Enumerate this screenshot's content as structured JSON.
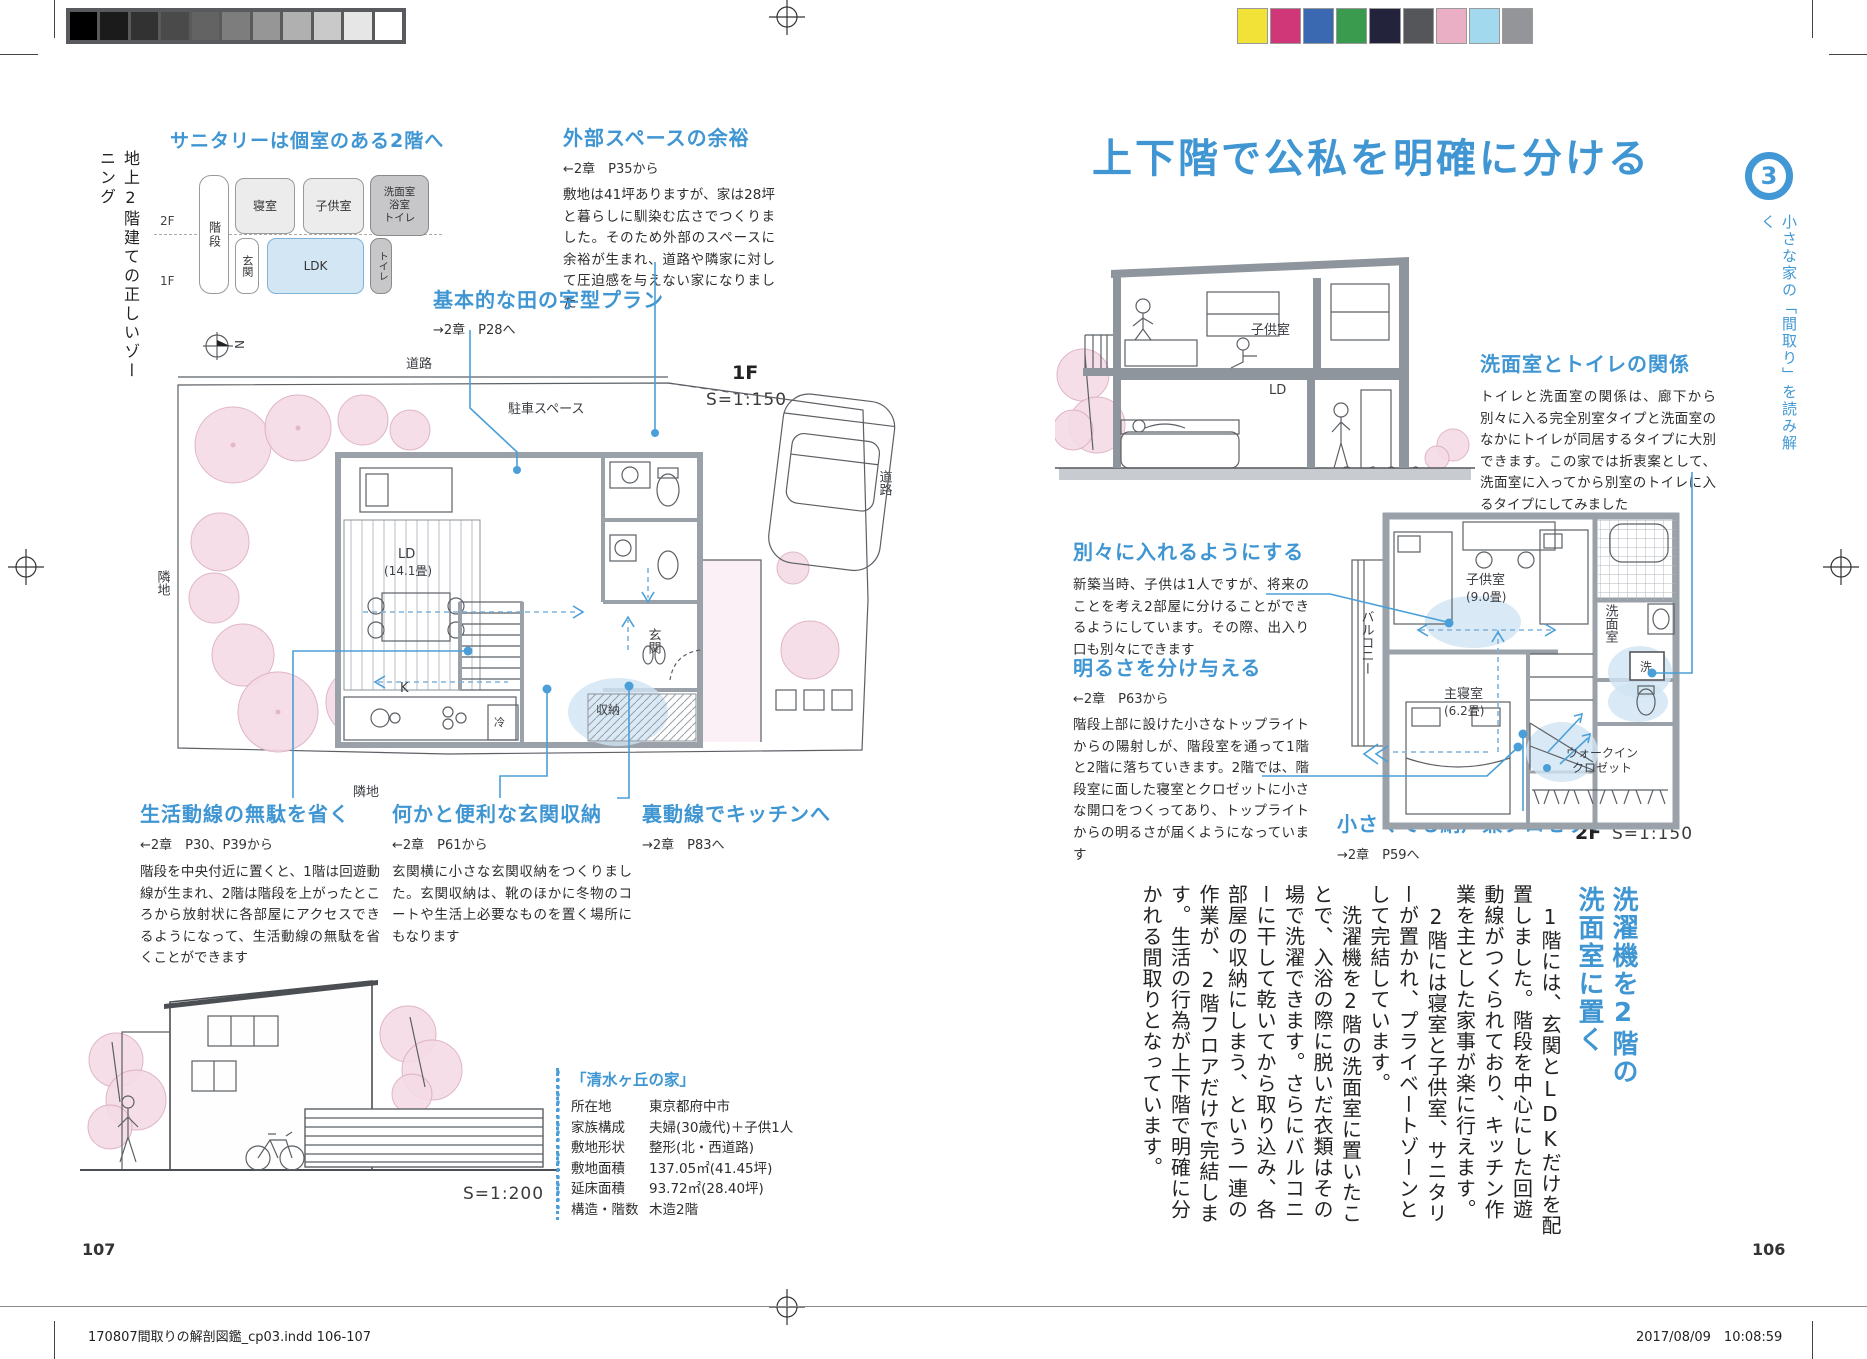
{
  "print": {
    "footer_left": "170807間取りの解剖図鑑_cp03.indd   106-107",
    "footer_right": "2017/08/09　10:08:59",
    "grayscale_swatches": [
      "#000000",
      "#1b1b1b",
      "#323232",
      "#4a4a4a",
      "#636363",
      "#7d7d7d",
      "#969696",
      "#b0b0b0",
      "#c9c9c9",
      "#e6e6e6",
      "#ffffff"
    ],
    "color_swatches": [
      "#f2e136",
      "#cf3779",
      "#3b69b1",
      "#3a9a4e",
      "#23233b",
      "#55565a",
      "#eaaec5",
      "#a2d9ee",
      "#939598"
    ]
  },
  "colors": {
    "accent_blue": "#3f96d2",
    "callout_blue": "#4a9fd8",
    "room_blue": "#d3e6f4",
    "room_gray": "#ececec",
    "room_dark": "#c7c7c9",
    "tree_pink": "#f5dbe6"
  },
  "left_page": {
    "page_number": "107",
    "sidebar_label": "地上2階建ての正しいゾーニング",
    "zoning": {
      "heading": "サニタリーは個室のある2階へ",
      "floor_2f": "2F",
      "floor_1f": "1F",
      "rooms": {
        "stairs": "階段",
        "bedroom": "寝室",
        "kids": "子供室",
        "sanitary": "洗面室\n浴室\nトイレ",
        "entrance": "玄関",
        "ldk": "LDK",
        "toilet": "トイレ"
      }
    },
    "annotations": {
      "outdoor": {
        "title": "外部スペースの余裕",
        "ref": "←2章　P35から",
        "body": "敷地は41坪ありますが、家は28坪と暮らしに馴染む広さでつくりました。そのため外部のスペースに余裕が生まれ、道路や隣家に対して圧迫感を与えない家になりました"
      },
      "grid_plan": {
        "title": "基本的な田の字型プラン",
        "ref": "→2章　P28へ"
      },
      "flow": {
        "title": "生活動線の無駄を省く",
        "ref": "←2章　P30、P39から",
        "body": "階段を中央付近に置くと、1階は回遊動線が生まれ、2階は階段を上がったところから放射状に各部屋にアクセスできるようになって、生活動線の無駄を省くことができます"
      },
      "storage": {
        "title": "何かと便利な玄関収納",
        "ref": "←2章　P61から",
        "body": "玄関横に小さな玄関収納をつくりました。玄関収納は、靴のほかに冬物のコートや生活上必要なものを置く場所にもなります"
      },
      "back_line": {
        "title": "裏動線でキッチンへ",
        "ref": "→2章　P83へ"
      }
    },
    "plan_1f": {
      "floor_label": "1F",
      "scale": "S=1:150",
      "labels": {
        "road_top": "道路",
        "parking": "駐車スペース",
        "ld": "LD",
        "ld_size": "(14.1畳)",
        "entrance": "玄関",
        "kitchen": "K",
        "fridge": "冷",
        "storage": "収納",
        "neighbor_left": "隣地",
        "neighbor_bottom": "隣地",
        "road_right": "道路",
        "north": "N"
      }
    },
    "elevation": {
      "scale": "S=1:200"
    },
    "house_info": {
      "title": "「清水ヶ丘の家」",
      "rows": [
        {
          "label": "所在地",
          "value": "東京都府中市"
        },
        {
          "label": "家族構成",
          "value": "夫婦(30歳代)＋子供1人"
        },
        {
          "label": "敷地形状",
          "value": "整形(北・西道路)"
        },
        {
          "label": "敷地面積",
          "value": "137.05㎡(41.45坪)"
        },
        {
          "label": "延床面積",
          "value": "93.72㎡(28.40坪)"
        },
        {
          "label": "構造・階数",
          "value": "木造2階"
        }
      ]
    }
  },
  "right_page": {
    "page_number": "106",
    "title": "上下階で公私を明確に分ける",
    "chapter_tab": {
      "number": "3",
      "label": "小さな家の「間取り」を読み解く"
    },
    "section": {
      "scale": "S=1:200",
      "labels": {
        "kids": "子供室",
        "ld": "LD"
      }
    },
    "annotations": {
      "wash_toilet": {
        "title": "洗面室とトイレの関係",
        "body": "トイレと洗面室の関係は、廊下から別々に入る完全別室タイプと洗面室のなかにトイレが同居するタイプに大別できます。この家では折衷案として、洗面室に入ってから別室のトイレに入るタイプにしてみました"
      },
      "separate": {
        "title": "別々に入れるようにする",
        "body": "新築当時、子供は1人ですが、将来のことを考え2部屋に分けることができるようにしています。その際、出入り口も別々にできます"
      },
      "light": {
        "title": "明るさを分け与える",
        "ref": "←2章　P63から",
        "body": "階段上部に設けた小さなトップライトからの陽射しが、階段室を通って1階と2階に落ちていきます。2階では、階段室に面した寝室とクロゼットに小さな開口をつくってあり、トップライトからの明るさが届くようになっています"
      },
      "closet": {
        "title": "小さくても納戸兼クロゼット",
        "ref": "→2章　P59へ"
      }
    },
    "plan_2f": {
      "floor_label": "2F",
      "scale": "S=1:150",
      "labels": {
        "balcony": "バルコニー",
        "kids": "子供室",
        "kids_size": "(9.0畳)",
        "washroom": "洗面室",
        "washer": "洗",
        "bedroom": "主寝室",
        "bedroom_size": "(6.2畳)",
        "wic1": "ウォークイン",
        "wic2": "クロゼット"
      }
    },
    "article": {
      "headline": "洗濯機を2階の\n洗面室に置く",
      "paragraphs": [
        "　1階には、玄関とLDKだけを配置しました。階段を中心にした回遊動線がつくられており、キッチン作業を主とした家事が楽に行えます。",
        "　2階には寝室と子供室、サニタリーが置かれ、プライベートゾーンとして完結しています。",
        "　洗濯機を2階の洗面室に置いたことで、入浴の際に脱いだ衣類はその場で洗濯できます。さらにバルコニーに干して乾いてから取り込み、各部屋の収納にしまう、という一連の作業が、2階フロアだけで完結します。生活の行為が上下階で明確に分かれる間取りとなっています。"
      ]
    }
  }
}
